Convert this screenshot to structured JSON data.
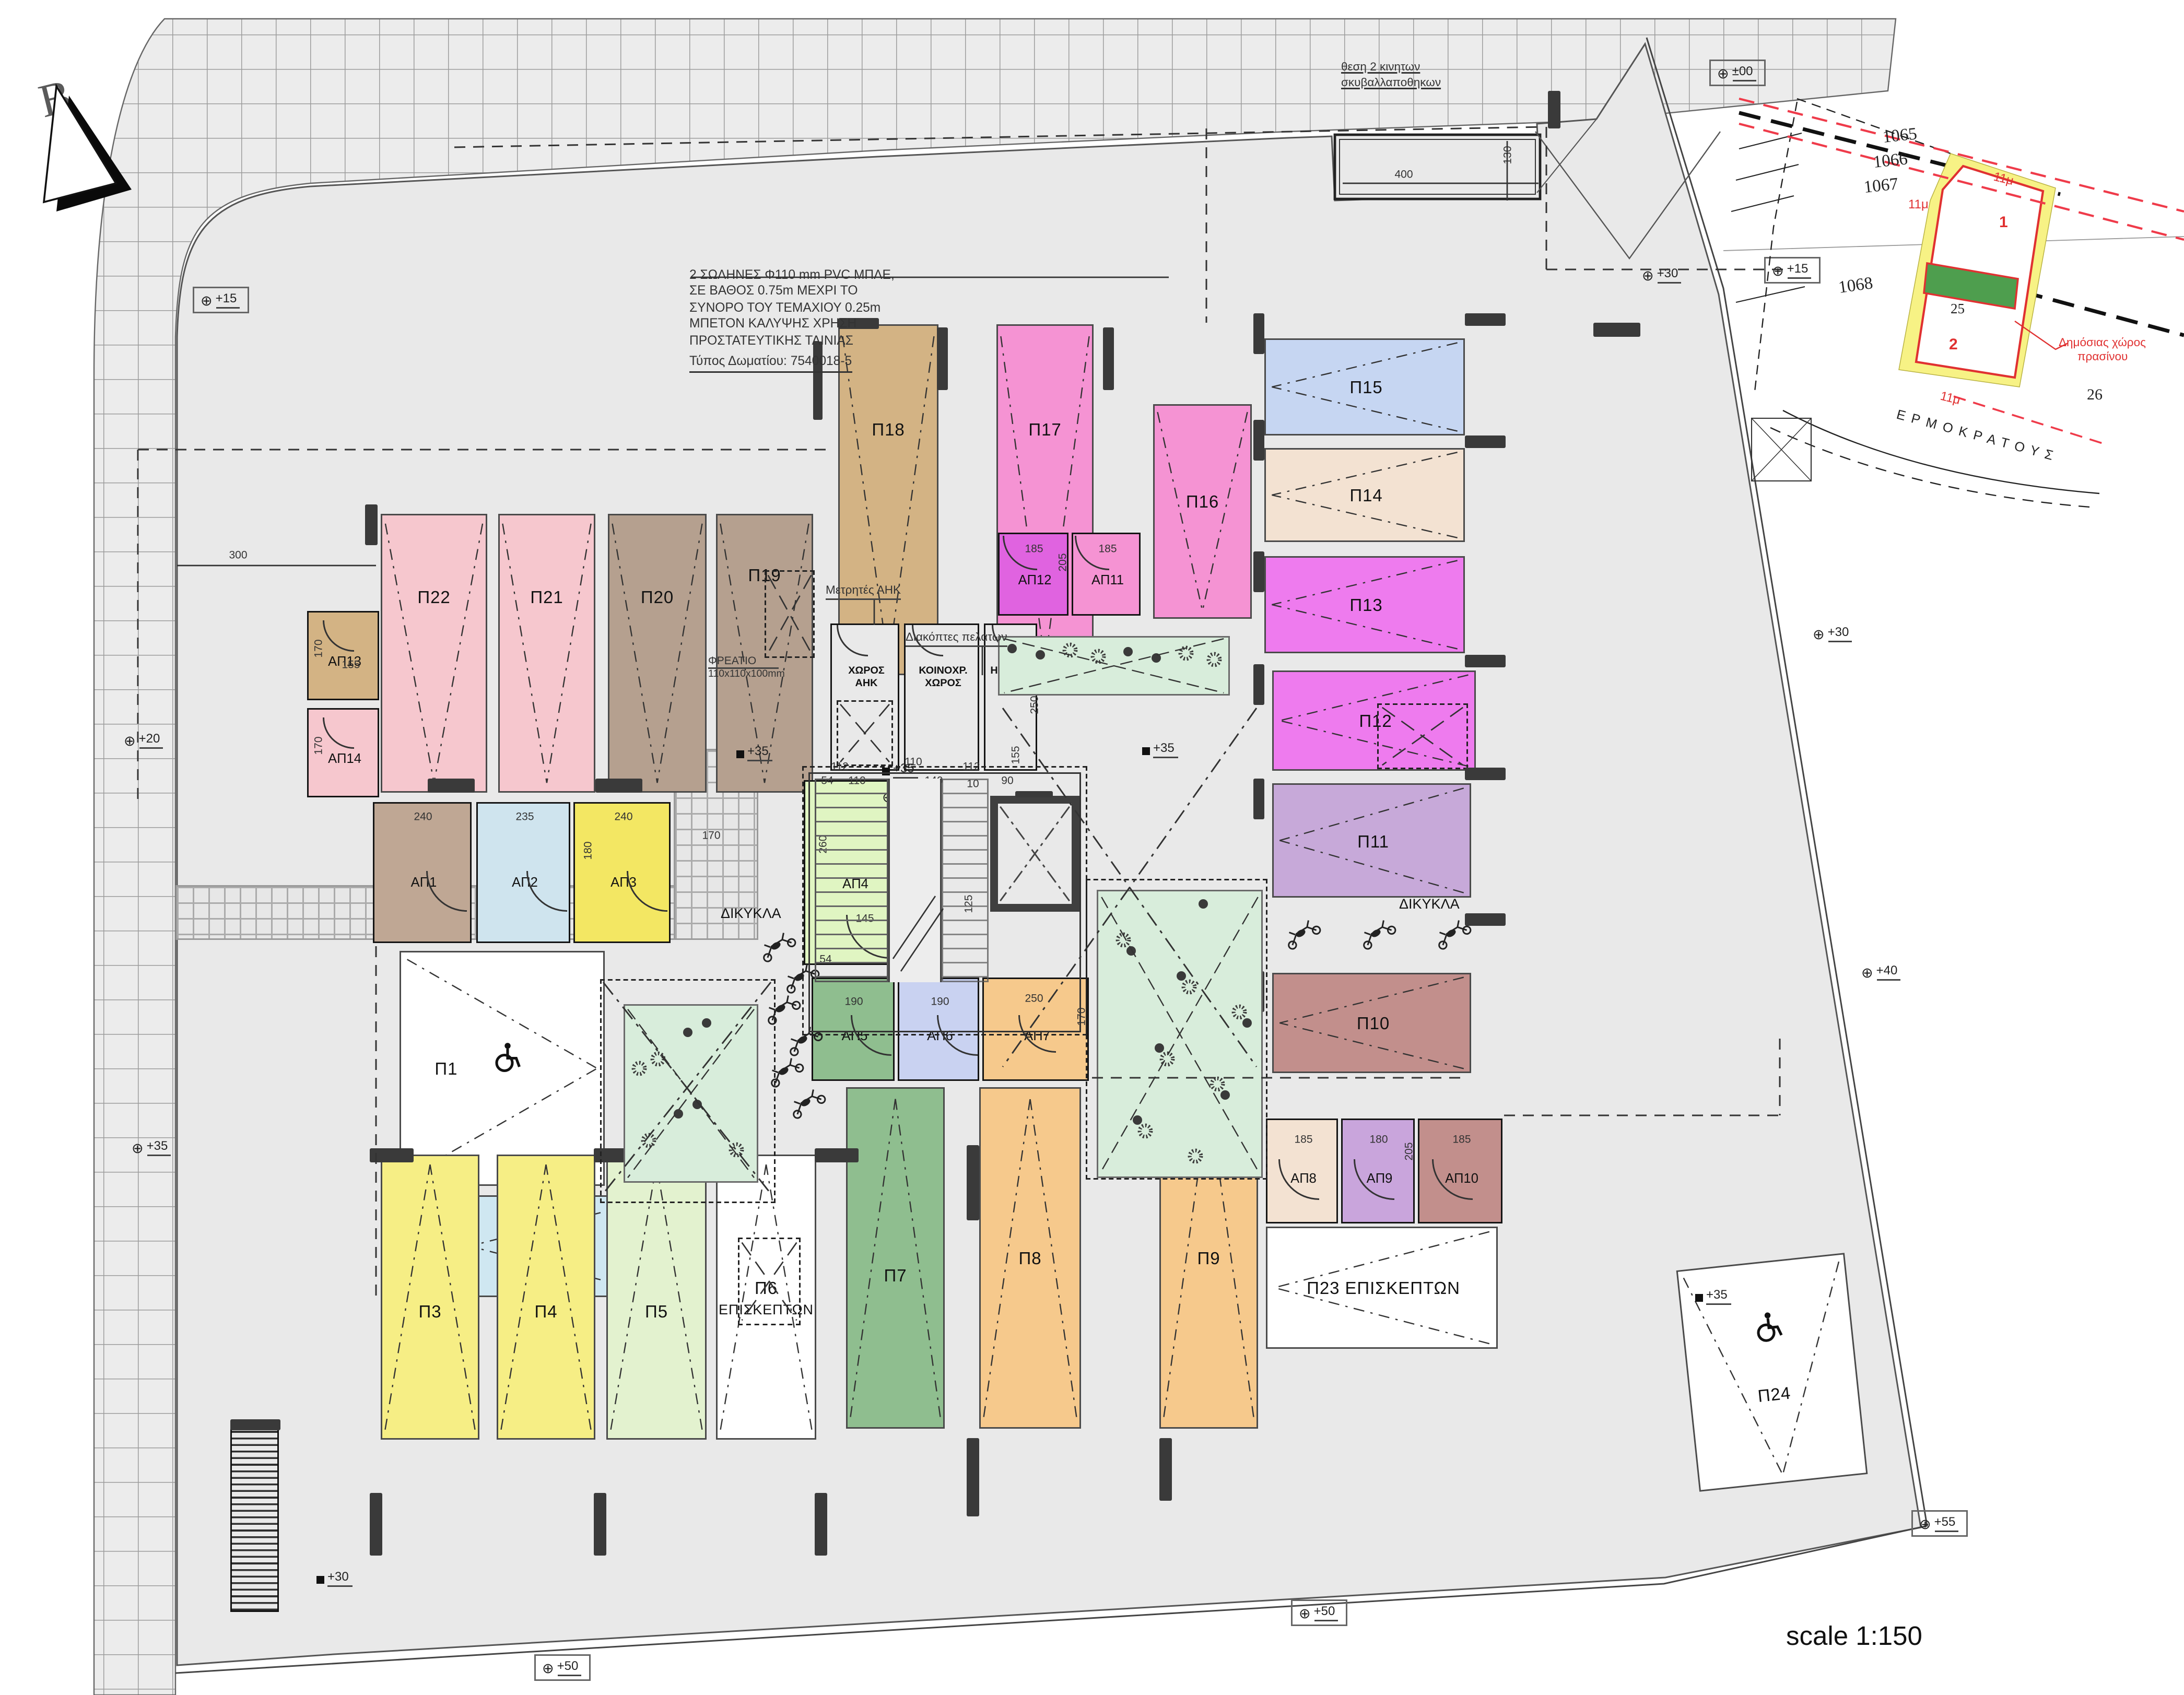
{
  "page": {
    "north_label": "B",
    "scale_label": "scale 1:150"
  },
  "notes": {
    "pipe_note_lines": [
      "2 ΣΩΛΗΝΕΣ Φ110 mm  PVC ΜΠΛΕ,",
      "ΣΕ ΒΑΘΟΣ 0.75m ΜΕΧΡΙ ΤΟ",
      "ΣΥΝΟΡΟ ΤΟΥ ΤΕΜΑΧΙΟΥ 0.25m",
      "ΜΠΕΤΟΝ ΚΑΛΥΨΗΣ ΧΡΗΣΗ",
      "ΠΡΟΣΤΑΤΕΥΤΙΚΗΣ ΤΑΙΝΙΑΣ"
    ],
    "room_type_note": "Τύπος Δωματίου: 7540018-5",
    "garbage_note_lines": [
      "θεση 2 κινητων",
      "σκυβαλλαποθηκων"
    ],
    "shaft_label": "ΦΡΕΑΤΙΟ",
    "shaft_size": "110x110x100mm",
    "meters_label": "Μετρητές  ΑΗΚ",
    "switches_label": "Διακόπτες πελατων",
    "moto_label_left": "ΔΙΚΥΚΛΑ",
    "moto_label_right": "ΔΙΚΥΚΛΑ"
  },
  "service_rooms": [
    {
      "id": "S1",
      "label_lines": [
        "ΧΩΡΟΣ",
        "ΑΗΚ"
      ]
    },
    {
      "id": "S2",
      "label_lines": [
        "ΚΟΙΝΟΧΡ.",
        "ΧΩΡΟΣ"
      ]
    },
    {
      "id": "S3",
      "label_lines": [
        "ΗΛΕΚΤΡ."
      ]
    }
  ],
  "parking_stalls": [
    {
      "id": "P1",
      "label": "Π1",
      "color": "#ffffff",
      "accessible": true
    },
    {
      "id": "P2",
      "label": "Π2",
      "color": "#cfe7f1"
    },
    {
      "id": "P3",
      "label": "Π3",
      "color": "#f6ee85"
    },
    {
      "id": "P4",
      "label": "Π4",
      "color": "#f6ee85"
    },
    {
      "id": "P5",
      "label": "Π5",
      "color": "#e3f2cf"
    },
    {
      "id": "P6",
      "label": "Π6",
      "label2": "ΕΠΙΣΚΕΠΤΩΝ",
      "color": "#ffffff"
    },
    {
      "id": "P7",
      "label": "Π7",
      "color": "#8fbe8f"
    },
    {
      "id": "P8",
      "label": "Π8",
      "color": "#f6c98c"
    },
    {
      "id": "P9",
      "label": "Π9",
      "color": "#f6c98c"
    },
    {
      "id": "P10",
      "label": "Π10",
      "color": "#c28f8c"
    },
    {
      "id": "P11",
      "label": "Π11",
      "color": "#c7a9d9"
    },
    {
      "id": "P12",
      "label": "Π12",
      "color": "#ee7bee"
    },
    {
      "id": "P13",
      "label": "Π13",
      "color": "#ee7bee"
    },
    {
      "id": "P14",
      "label": "Π14",
      "color": "#f3e2d2"
    },
    {
      "id": "P15",
      "label": "Π15",
      "color": "#c6d6f2"
    },
    {
      "id": "P16",
      "label": "Π16",
      "color": "#f593d3"
    },
    {
      "id": "P17",
      "label": "Π17",
      "color": "#f593d3"
    },
    {
      "id": "P18",
      "label": "Π18",
      "color": "#d3b384"
    },
    {
      "id": "P19",
      "label": "Π19",
      "color": "#b5a08f"
    },
    {
      "id": "P20",
      "label": "Π20",
      "color": "#b5a08f"
    },
    {
      "id": "P21",
      "label": "Π21",
      "color": "#f6c7ce"
    },
    {
      "id": "P22",
      "label": "Π22",
      "color": "#f6c7ce"
    },
    {
      "id": "P23",
      "label": "Π23",
      "label2": "ΕΠΙΣΚΕΠΤΩΝ",
      "inline2": true,
      "color": "#ffffff"
    },
    {
      "id": "P24",
      "label": "Π24",
      "color": "#ffffff",
      "accessible": true
    }
  ],
  "storage_rooms": [
    {
      "id": "A1",
      "label": "ΑΠ1",
      "color": "#bfa794",
      "dims": [
        "240"
      ]
    },
    {
      "id": "A2",
      "label": "ΑΠ2",
      "color": "#cfe4ee",
      "dims": [
        "235"
      ]
    },
    {
      "id": "A3",
      "label": "ΑΠ3",
      "color": "#f3e763",
      "dims": [
        "240",
        "180"
      ]
    },
    {
      "id": "A4",
      "label": "ΑΠ4",
      "color": "#e0f5c2",
      "dims": [
        "260",
        "145"
      ]
    },
    {
      "id": "A5",
      "label": "ΑΠ5",
      "color": "#8fbe8f",
      "dims": [
        "190"
      ]
    },
    {
      "id": "A6",
      "label": "ΑΠ6",
      "color": "#c9d2f1",
      "dims": [
        "190"
      ]
    },
    {
      "id": "A7",
      "label": "ΑΠ7",
      "color": "#f6c98c",
      "dims": [
        "250",
        "170"
      ]
    },
    {
      "id": "A8",
      "label": "ΑΠ8",
      "color": "#f3e2d2",
      "dims": [
        "185"
      ]
    },
    {
      "id": "A9",
      "label": "ΑΠ9",
      "color": "#c9a5dc",
      "dims": [
        "180",
        "205"
      ]
    },
    {
      "id": "A10",
      "label": "ΑΠ10",
      "color": "#c28f8c",
      "dims": [
        "185"
      ]
    },
    {
      "id": "A11",
      "label": "ΑΠ11",
      "color": "#f593d3",
      "dims": [
        "185"
      ]
    },
    {
      "id": "A12",
      "label": "ΑΠ12",
      "color": "#e063e0",
      "dims": [
        "185",
        "205"
      ]
    },
    {
      "id": "A13",
      "label": "ΑΠ13",
      "color": "#d3b384",
      "dims": [
        "155",
        "170"
      ]
    },
    {
      "id": "A14",
      "label": "ΑΠ14",
      "color": "#f6c7ce",
      "dims": [
        "170"
      ]
    }
  ],
  "levels": [
    {
      "text": "+15",
      "boxed": true,
      "square": false
    },
    {
      "text": "±00",
      "boxed": true,
      "square": false
    },
    {
      "text": "+15",
      "boxed": true,
      "square": false
    },
    {
      "text": "+30",
      "boxed": false,
      "square": false
    },
    {
      "text": "+30",
      "boxed": false,
      "square": false
    },
    {
      "text": "+40",
      "boxed": false,
      "square": false
    },
    {
      "text": "+35",
      "boxed": false,
      "square": true
    },
    {
      "text": "+55",
      "boxed": true,
      "square": false
    },
    {
      "text": "+50",
      "boxed": true,
      "square": false
    },
    {
      "text": "+50",
      "boxed": true,
      "square": false
    },
    {
      "text": "+30",
      "boxed": false,
      "square": true
    },
    {
      "text": "+20",
      "boxed": false,
      "square": false
    },
    {
      "text": "+35",
      "boxed": false,
      "square": false
    },
    {
      "text": "+35",
      "boxed": false,
      "square": true
    },
    {
      "text": "+35",
      "boxed": false,
      "square": true
    },
    {
      "text": "+20",
      "boxed": false,
      "square": false
    },
    {
      "text": "+35",
      "boxed": false,
      "square": true
    }
  ],
  "dim_texts": [
    "110",
    "10",
    "140",
    "10",
    "90",
    "250",
    "195",
    "125",
    "155",
    "19",
    "112",
    "110",
    "112",
    "54",
    "54",
    "180",
    "180",
    "400",
    "130",
    "300",
    "170"
  ],
  "inset_map": {
    "parcels": [
      "1065",
      "1066",
      "1067",
      "1068"
    ],
    "plot_numbers": [
      "1",
      "2"
    ],
    "lot_numbers": [
      "25",
      "26"
    ],
    "width_labels": [
      "11μ",
      "11μ",
      "11μ"
    ],
    "green_label_lines": [
      "Δημόσιας χώρος",
      "πρασίνου"
    ],
    "street": "ΕΡΜΟΚΡΑΤΟΥΣ"
  },
  "colors": {
    "site_gray": "#e9e9e9",
    "sidewalk_gray": "#ececec",
    "wall_dark": "#3a3a3a",
    "planter_green": "#d8eddb",
    "inset_red": "#e03131",
    "inset_yellow": "#f7f285",
    "inset_green": "#4e9e4e"
  }
}
